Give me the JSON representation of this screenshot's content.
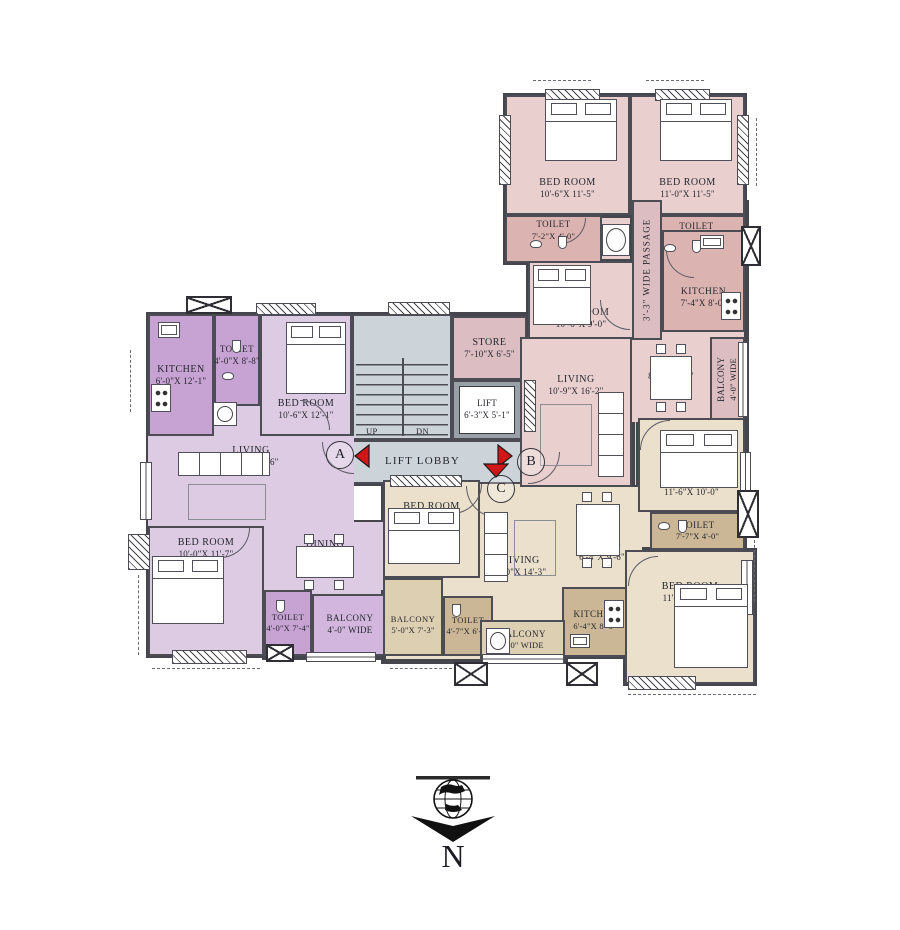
{
  "plan": {
    "core": {
      "store": {
        "name": "STORE",
        "dims": "7'-10\"X 6'-5\""
      },
      "lift": {
        "name": "LIFT",
        "dims": "6'-3\"X 5'-1\""
      },
      "lobby": "LIFT LOBBY",
      "up": "UP",
      "dn": "DN"
    },
    "unit_a": {
      "kitchen": {
        "name": "KITCHEN",
        "dims": "6'-0\"X 12'-1\""
      },
      "toilet1": {
        "name": "TOILET",
        "dims": "4'-0\"X 8'-8\""
      },
      "bed1": {
        "name": "BED ROOM",
        "dims": "10'-6\"X 12'-1\""
      },
      "living": {
        "name": "LIVING",
        "dims": "21'-2\"X 10'-6\""
      },
      "bed2": {
        "name": "BED ROOM",
        "dims": "10'-0\"X 11'-7\""
      },
      "dining": {
        "name": "DINING",
        "dims": "14'-4\"X 8'-3\""
      },
      "toilet2": {
        "name": "TOILET",
        "dims": "4'-0\"X 7'-4\""
      },
      "balcony": {
        "name": "BALCONY",
        "dims": "4'-0\" WIDE"
      }
    },
    "unit_b": {
      "bed1": {
        "name": "BED ROOM",
        "dims": "10'-6\"X 11'-5\""
      },
      "bed2": {
        "name": "BED ROOM",
        "dims": "11'-0\"X 11'-5\""
      },
      "toilet1": {
        "name": "TOILET",
        "dims": "7'-2\"X 4'-0\""
      },
      "toilet2": {
        "name": "TOILET",
        "dims": "7'-4\"X 5'-0\""
      },
      "bed3": {
        "name": "BED ROOM",
        "dims": "10'-6\"X 9'-0\""
      },
      "kitchen": {
        "name": "KITCHEN",
        "dims": "7'-4\"X 8'-0\""
      },
      "passage": {
        "name": "3'-3\" WIDE PASSAGE"
      },
      "living": {
        "name": "LIVING",
        "dims": "10'-9\"X 16'-2\""
      },
      "dining": {
        "name": "DINING",
        "dims": "8'-2\"X 8'-0\""
      },
      "balcony": {
        "name": "BALCONY",
        "dims": "4'-0\" WIDE"
      }
    },
    "unit_c": {
      "bed1": {
        "name": "BED ROOM",
        "dims": "11'-6\"X 10'-0\""
      },
      "toilet1": {
        "name": "TOILET",
        "dims": "7'-7\"X 4'-0\""
      },
      "bed2": {
        "name": "BED ROOM",
        "dims": "11'-1\"X 13'-6\""
      },
      "kitchen": {
        "name": "KITCHEN",
        "dims": "6'-4\"X 8'-0\""
      },
      "dining": {
        "name": "DINING",
        "dims": "6'-4\"X 9'-6\""
      },
      "living": {
        "name": "LIVING",
        "dims": "9'-0\"X 14'-3\""
      },
      "bed3": {
        "name": "BED ROOM",
        "dims": "10'-0\"X 12'-3\""
      },
      "balcony1": {
        "name": "BALCONY",
        "dims": "5'-0\"X 7'-3\""
      },
      "toilet2": {
        "name": "TOILET",
        "dims": "4'-7\"X 6'-5\""
      },
      "balcony2": {
        "name": "BALCONY",
        "dims": "4'-0\" WIDE"
      }
    },
    "markers": {
      "a": "A",
      "b": "B",
      "c": "C"
    },
    "compass_label": "N"
  },
  "colors": {
    "wall": "#45454e",
    "wall2": "#4c4c55",
    "ink": "#26262e",
    "purB": "#ddcbe4",
    "purA": "#c6a3d2",
    "purM": "#d2b6de",
    "pinB": "#e9d0ce",
    "pinA": "#dbb3b1",
    "pinM": "#dcbec2",
    "beiB": "#eae0cb",
    "beiA": "#cbb795",
    "beiM": "#ddcfb2",
    "core": "#ccd3d9",
    "red": "#d01616"
  }
}
